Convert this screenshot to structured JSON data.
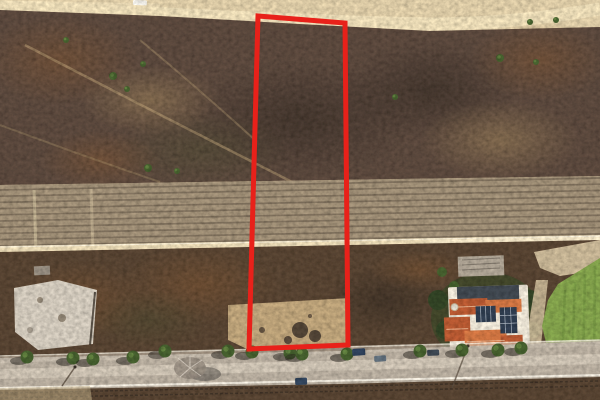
{
  "meta": {
    "description": "Aerial drone photograph of a vacant brushland parcel outlined with a red property boundary; old crop rows and a dirt road cross the middle, a tree-lined paved street runs along the bottom with a tile-roofed house with solar panels and a green lawn at lower right",
    "image_type": "aerial-drone-photo",
    "visible_text": "none"
  },
  "boundary": {
    "points": "258,16 345,23 348,345 249,349",
    "stroke_width": 5
  },
  "colors": {
    "boundary_red": "#e8211a",
    "dirt": "#c4b18c",
    "road_pale": "#e3d4b0",
    "chap": "#57453a",
    "chap2": "#53402f",
    "rows": "#9a8a72",
    "rows_line": "#5f5244",
    "trail": "#b49a72",
    "rock": "#c9c1b4",
    "pad": "#b59c74",
    "debris": "#3c3128",
    "garden": "#3f4328",
    "tree": "#415a2b",
    "tree_l": "#628140",
    "tree_dark": "#2f4023",
    "lawn": "#7d9b48",
    "lawn_dark": "#6a8a3c",
    "gravel": "#bfae8f",
    "wall": "#e2dbcc",
    "roof": "#b0552f",
    "roof_l": "#c8703f",
    "solar": "#2d3a4c",
    "street": "#b0a698",
    "street_l": "#c9bfb0",
    "street_edge": "#ece7da"
  },
  "scene": {
    "bushes": [
      [
        113,
        76,
        4
      ],
      [
        127,
        89,
        3
      ],
      [
        143,
        64,
        3
      ],
      [
        66,
        40,
        3
      ],
      [
        148,
        168,
        4
      ],
      [
        177,
        171,
        3
      ],
      [
        395,
        97,
        3
      ],
      [
        500,
        58,
        4
      ],
      [
        536,
        62,
        3
      ],
      [
        556,
        20,
        3
      ],
      [
        530,
        22,
        3
      ],
      [
        590,
        222,
        4
      ],
      [
        596,
        232,
        3
      ],
      [
        586,
        200,
        3
      ]
    ],
    "crop_rows": {
      "count": 10,
      "y_left_start": 190,
      "spacing": 6.2,
      "y_right_offset": -12
    },
    "street_trees": [
      [
        27,
        357
      ],
      [
        73,
        358
      ],
      [
        93,
        359
      ],
      [
        133,
        357
      ],
      [
        165,
        351
      ],
      [
        228,
        351
      ],
      [
        252,
        352
      ],
      [
        290,
        353
      ],
      [
        302,
        354
      ],
      [
        347,
        354
      ],
      [
        420,
        351
      ],
      [
        462,
        350
      ],
      [
        498,
        350
      ],
      [
        521,
        348
      ]
    ],
    "vehicles": [
      {
        "x": 352,
        "y": 349,
        "w": 13,
        "h": 7,
        "color": "#2c3e57",
        "angle": -4
      },
      {
        "x": 374,
        "y": 356,
        "w": 12,
        "h": 6,
        "color": "#5d6b77",
        "angle": -4
      },
      {
        "x": 427,
        "y": 350,
        "w": 12,
        "h": 6,
        "color": "#39424d",
        "angle": -3
      },
      {
        "x": 295,
        "y": 378,
        "w": 12,
        "h": 7,
        "color": "#2f4158",
        "angle": -2
      },
      {
        "x": 133,
        "y": 0,
        "w": 14,
        "h": 5,
        "color": "#e8e6e0",
        "angle": 2
      }
    ]
  }
}
